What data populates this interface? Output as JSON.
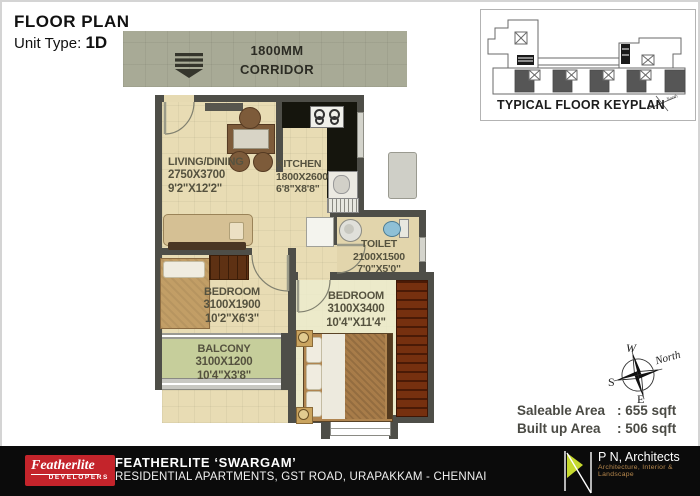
{
  "header": {
    "title": "FLOOR PLAN",
    "unit_label": "Unit Type:",
    "unit_value": "1D"
  },
  "corridor": {
    "width_label": "1800MM",
    "name": "CORRIDOR"
  },
  "keyplan": {
    "title": "TYPICAL FLOOR KEYPLAN",
    "north_label": "North"
  },
  "rooms": {
    "living": {
      "name": "LIVING/DINING",
      "mm": "2750X3700",
      "ft": "9'2\"X12'2\""
    },
    "kitchen": {
      "name": "KITCHEN",
      "mm": "1800X2600",
      "ft": "6'8\"X8'8\""
    },
    "toilet": {
      "name": "TOILET",
      "mm": "2100X1500",
      "ft": "7'0\"X5'0\""
    },
    "bedroom1": {
      "name": "BEDROOM",
      "mm": "3100X1900",
      "ft": "10'2\"X6'3\""
    },
    "bedroom2": {
      "name": "BEDROOM",
      "mm": "3100X3400",
      "ft": "10'4\"X11'4\""
    },
    "balcony": {
      "name": "BALCONY",
      "mm": "3100X1200",
      "ft": "10'4\"X3'8\""
    }
  },
  "compass": {
    "w": "W",
    "n": "North",
    "s": "S",
    "e": "E"
  },
  "areas": {
    "saleable_label": "Saleable Area",
    "saleable_value": ": 655 sqft",
    "builtup_label": "Built up Area",
    "builtup_value": ": 506 sqft"
  },
  "footer": {
    "brand_name": "Featherlite",
    "brand_sub": "DEVELOPERS",
    "project": "FEATHERLITE ‘SWARGAM’",
    "address": "RESIDENTIAL APARTMENTS, GST ROAD, URAPAKKAM - CHENNAI",
    "architect_name": "P N, Architects",
    "architect_sub": "Architecture, Interior & Landscape"
  },
  "colors": {
    "wall": "#4e4e48",
    "floor": "#e8dcb4",
    "balcony": "#c6ce9b",
    "corridor": "#a8aa96",
    "brand_red": "#c4242b",
    "logo_lime": "#c6d92e"
  }
}
